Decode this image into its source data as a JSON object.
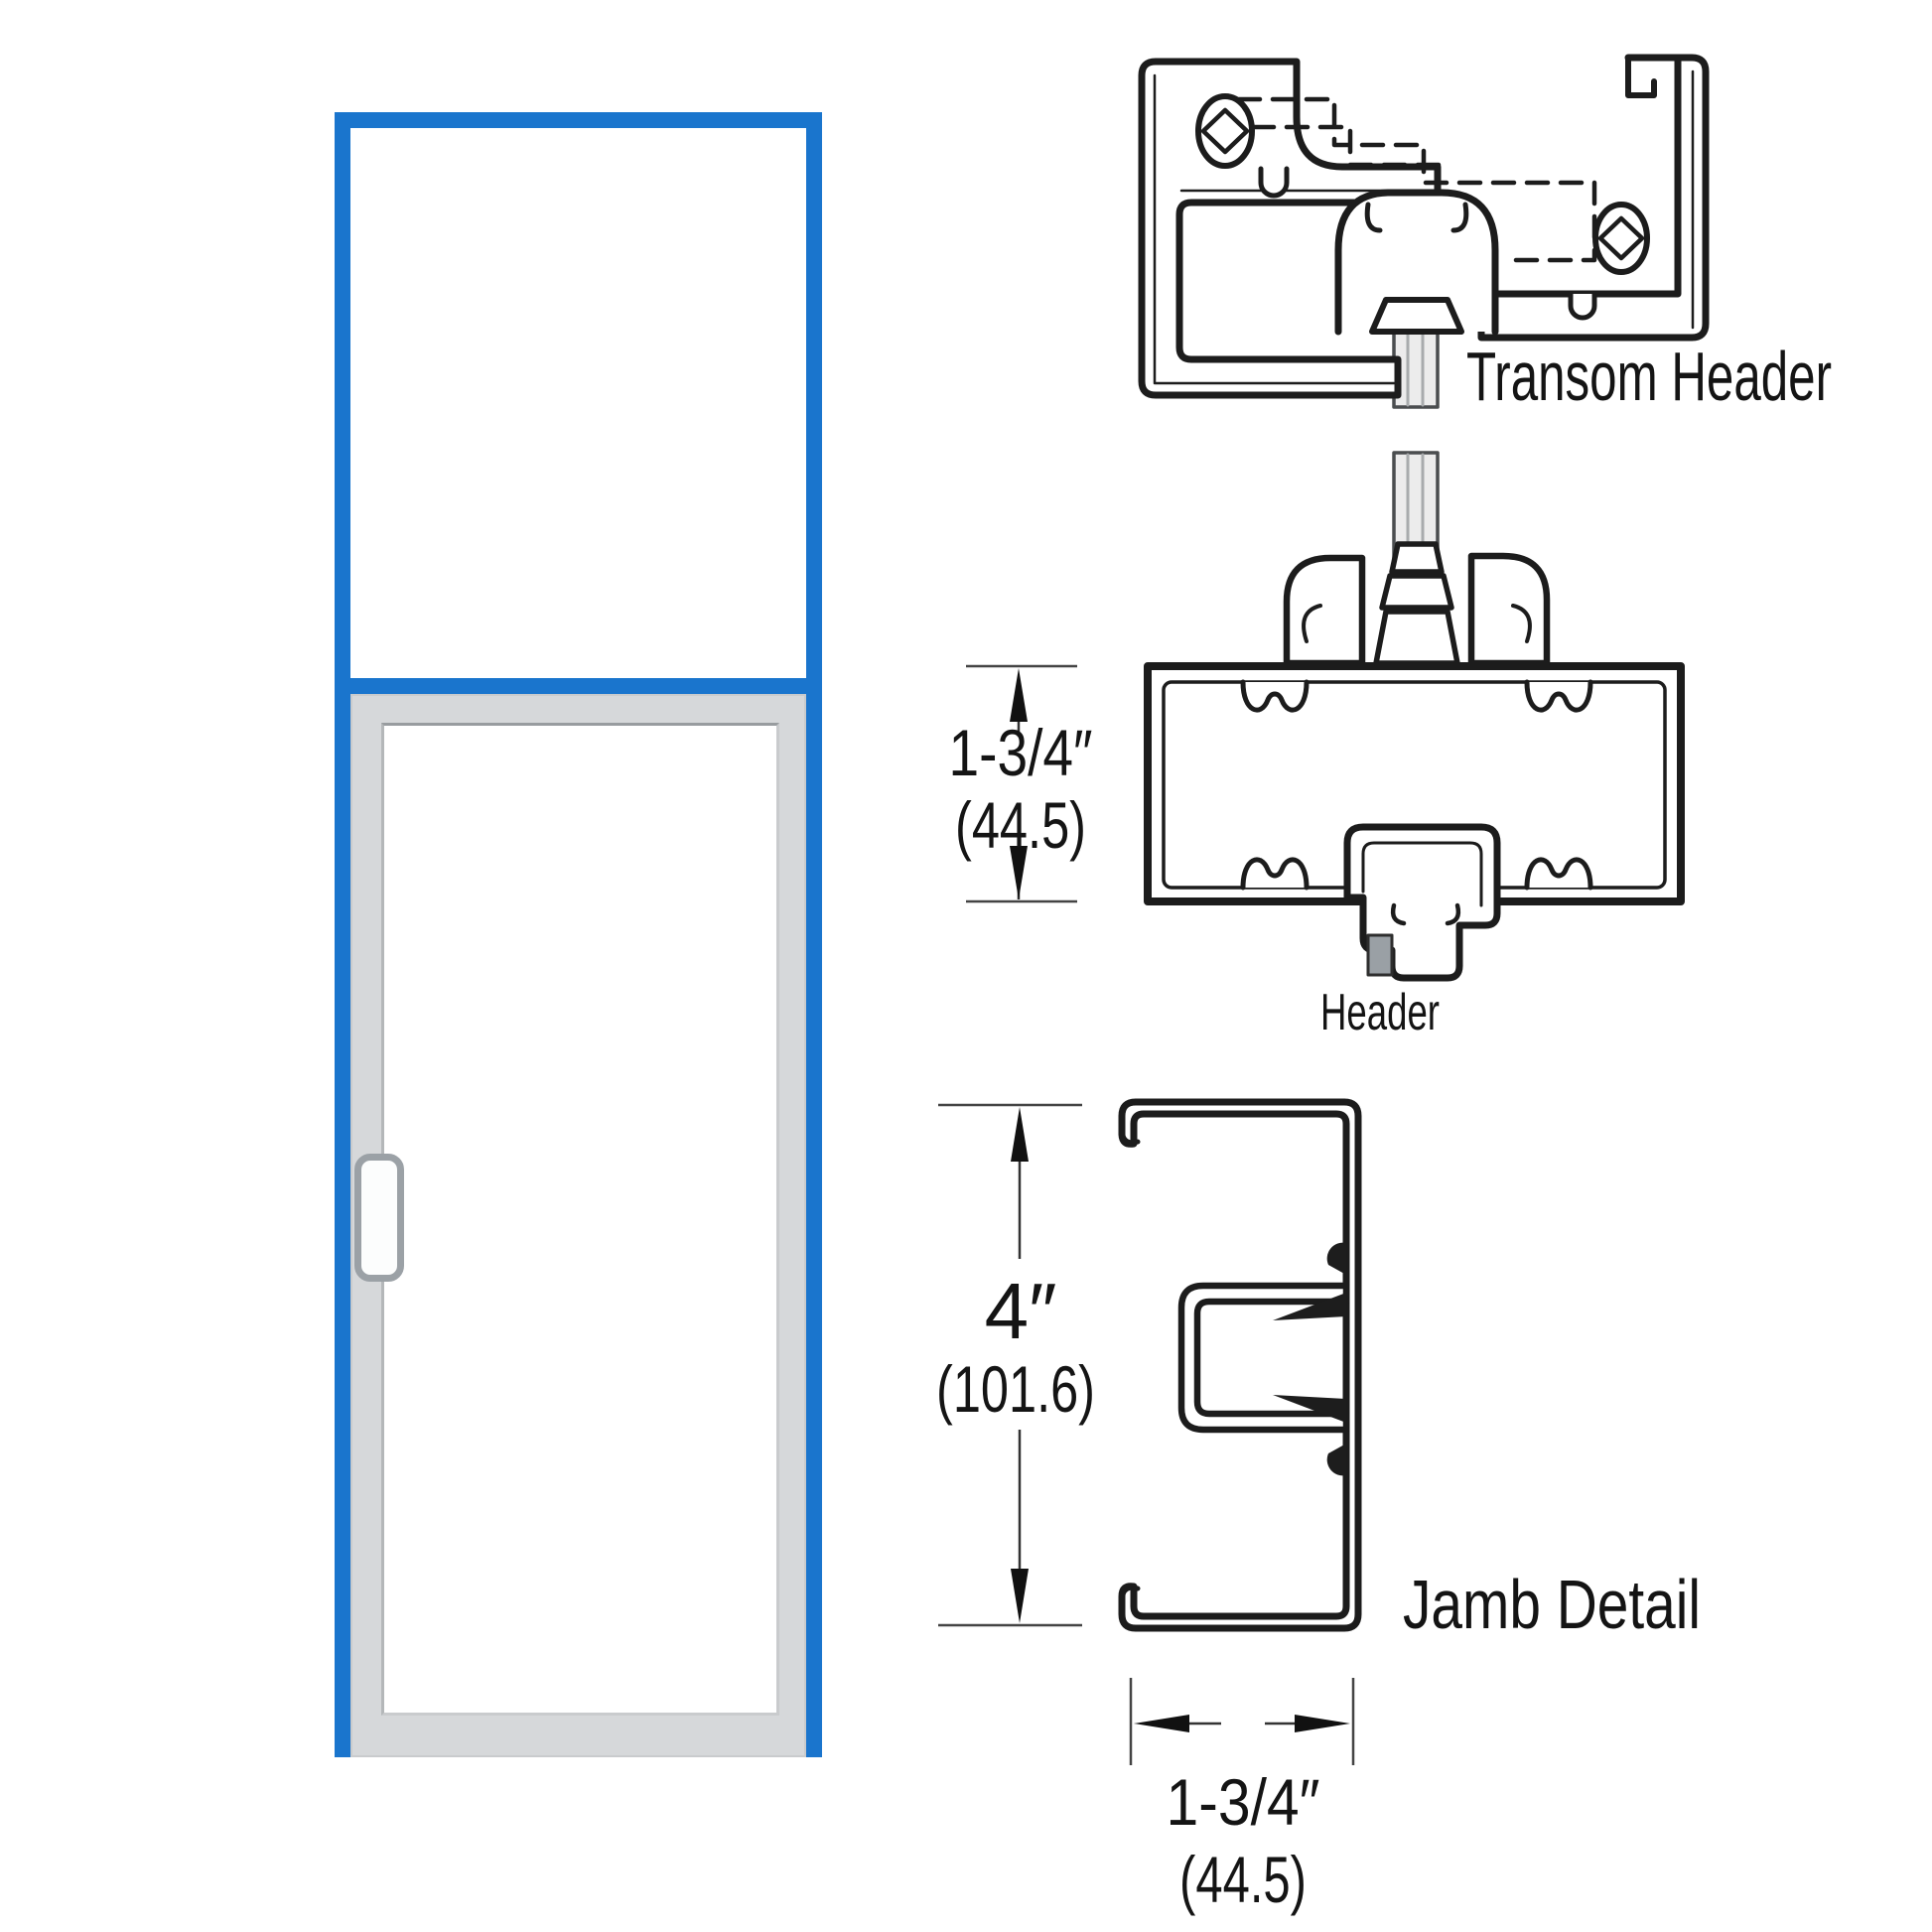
{
  "colors": {
    "frame_blue": "#1a75cd",
    "door_gray": "#d6d8da",
    "glass_white": "#ffffff",
    "drawing_line": "#1c1c1c",
    "steel_clip_gray": "#9aa0a5",
    "glass_strip_gray": "#ececec"
  },
  "labels": {
    "transom_header": "Transom Header",
    "header": "Header",
    "jamb": "Jamb Detail"
  },
  "dimensions": {
    "header_height": {
      "imperial": "1-3/4″",
      "metric": "(44.5)"
    },
    "jamb_height": {
      "imperial": "4″",
      "metric": "(101.6)"
    },
    "jamb_width": {
      "imperial": "1-3/4″",
      "metric": "(44.5)"
    }
  }
}
